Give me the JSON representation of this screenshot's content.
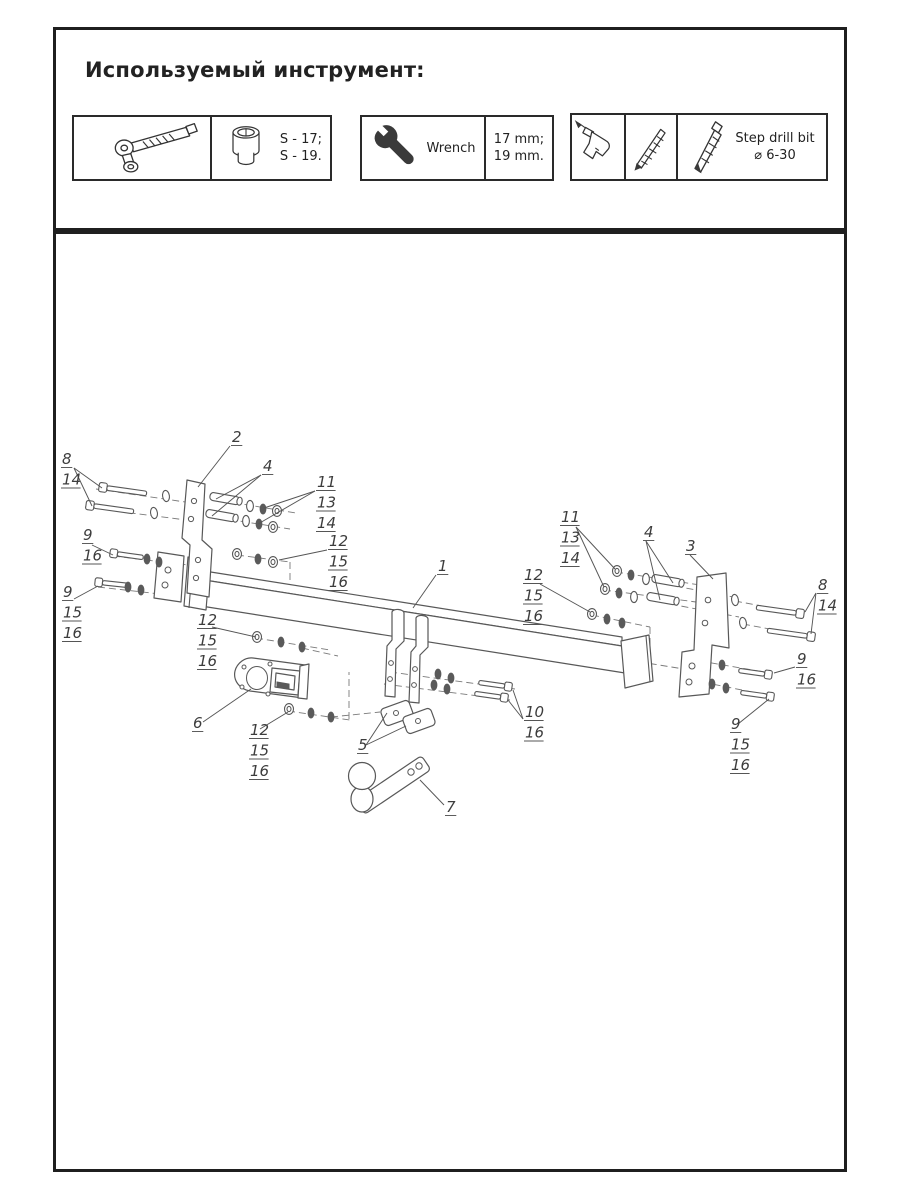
{
  "page_title": "Используемый инструмент:",
  "tools": {
    "socket": {
      "spec1": "S - 17;",
      "spec2": "S - 19."
    },
    "wrench": {
      "label": "Wrench",
      "spec1": "17 mm;",
      "spec2": "19 mm."
    },
    "step_drill": {
      "line1": "Step drill bit",
      "line2": "⌀ 6-30"
    }
  },
  "diagram": {
    "callouts": [
      {
        "labels": [
          "8",
          "14"
        ],
        "x": 62,
        "y": 464,
        "leaders": [
          [
            74,
            468,
            102,
            488
          ],
          [
            74,
            468,
            92,
            506
          ]
        ]
      },
      {
        "labels": [
          "2"
        ],
        "x": 232,
        "y": 442,
        "leaders": [
          [
            230,
            446,
            198,
            487
          ]
        ]
      },
      {
        "labels": [
          "4"
        ],
        "x": 263,
        "y": 471,
        "leaders": [
          [
            261,
            475,
            216,
            499
          ],
          [
            261,
            475,
            212,
            516
          ]
        ]
      },
      {
        "labels": [
          "11",
          "13",
          "14"
        ],
        "x": 317,
        "y": 487,
        "leaders": [
          [
            315,
            491,
            264,
            508
          ],
          [
            315,
            491,
            258,
            524
          ]
        ]
      },
      {
        "labels": [
          "9",
          "16"
        ],
        "x": 83,
        "y": 540,
        "leaders": [
          [
            92,
            545,
            113,
            555
          ]
        ]
      },
      {
        "labels": [
          "12",
          "15",
          "16"
        ],
        "x": 329,
        "y": 546,
        "leaders": [
          [
            327,
            550,
            279,
            560
          ]
        ]
      },
      {
        "labels": [
          "9",
          "15",
          "16"
        ],
        "x": 63,
        "y": 597,
        "leaders": [
          [
            74,
            599,
            98,
            586
          ]
        ]
      },
      {
        "labels": [
          "1"
        ],
        "x": 438,
        "y": 571,
        "leaders": [
          [
            436,
            575,
            413,
            608
          ]
        ]
      },
      {
        "labels": [
          "12",
          "15",
          "16"
        ],
        "x": 198,
        "y": 625,
        "leaders": [
          [
            212,
            627,
            256,
            637
          ]
        ]
      },
      {
        "labels": [
          "6"
        ],
        "x": 193,
        "y": 728,
        "leaders": [
          [
            203,
            722,
            251,
            689
          ]
        ]
      },
      {
        "labels": [
          "12",
          "15",
          "16"
        ],
        "x": 250,
        "y": 735,
        "leaders": [
          [
            260,
            729,
            288,
            712
          ]
        ]
      },
      {
        "labels": [
          "5"
        ],
        "x": 358,
        "y": 750,
        "leaders": [
          [
            366,
            745,
            387,
            713
          ],
          [
            366,
            745,
            406,
            726
          ]
        ]
      },
      {
        "labels": [
          "7"
        ],
        "x": 446,
        "y": 812,
        "leaders": [
          [
            444,
            805,
            420,
            780
          ]
        ]
      },
      {
        "labels": [
          "10",
          "16"
        ],
        "x": 525,
        "y": 717,
        "leaders": [
          [
            523,
            719,
            513,
            690
          ],
          [
            523,
            719,
            508,
            700
          ]
        ]
      },
      {
        "labels": [
          "11",
          "13",
          "14"
        ],
        "x": 561,
        "y": 522,
        "leaders": [
          [
            576,
            527,
            615,
            569
          ],
          [
            576,
            527,
            604,
            587
          ]
        ]
      },
      {
        "labels": [
          "12",
          "15",
          "16"
        ],
        "x": 524,
        "y": 580,
        "leaders": [
          [
            540,
            584,
            590,
            612
          ]
        ]
      },
      {
        "labels": [
          "4"
        ],
        "x": 644,
        "y": 537,
        "leaders": [
          [
            646,
            541,
            673,
            583
          ],
          [
            646,
            541,
            660,
            600
          ]
        ]
      },
      {
        "labels": [
          "3"
        ],
        "x": 686,
        "y": 551,
        "leaders": [
          [
            690,
            555,
            713,
            579
          ]
        ]
      },
      {
        "labels": [
          "8",
          "14"
        ],
        "x": 818,
        "y": 590,
        "leaders": [
          [
            816,
            593,
            805,
            612
          ],
          [
            816,
            593,
            811,
            634
          ]
        ]
      },
      {
        "labels": [
          "9",
          "16"
        ],
        "x": 797,
        "y": 664,
        "leaders": [
          [
            795,
            667,
            774,
            673
          ]
        ]
      },
      {
        "labels": [
          "9",
          "15",
          "16"
        ],
        "x": 731,
        "y": 729,
        "leaders": [
          [
            738,
            724,
            769,
            699
          ]
        ]
      }
    ]
  }
}
